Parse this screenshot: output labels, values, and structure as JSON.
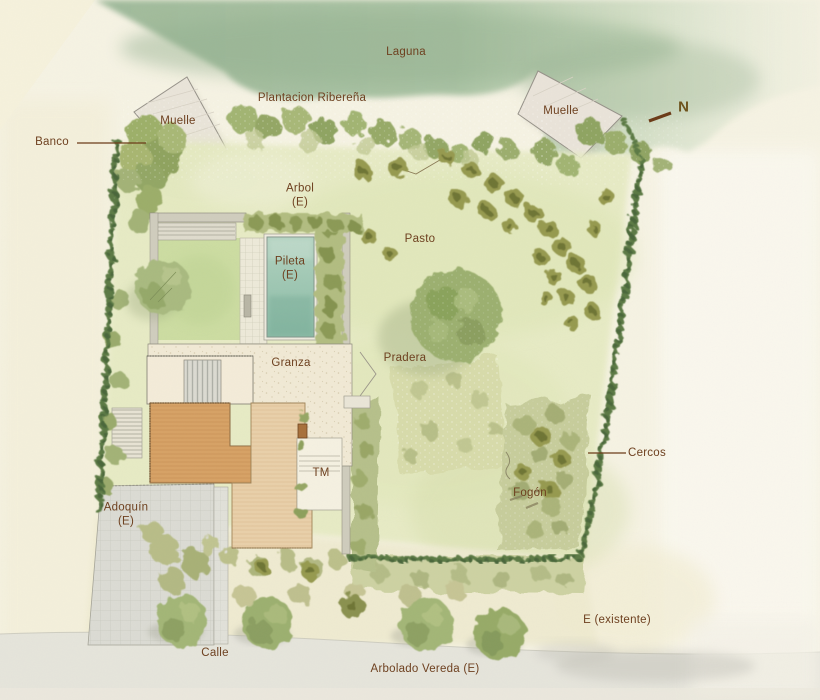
{
  "annotations": {
    "laguna": "Laguna",
    "plantacion_riberena": "Plantacion Ribereña",
    "muelle_oeste": "Muelle",
    "muelle_este": "Muelle",
    "norte": "N",
    "banco": "Banco",
    "arbol": "Arbol",
    "arbol_e": "(E)",
    "pasto": "Pasto",
    "pileta": "Pileta",
    "pileta_e": "(E)",
    "granza": "Granza",
    "pradera": "Pradera",
    "tm": "TM",
    "fogon": "Fogón",
    "cercos": "Cercos",
    "adoquin": "Adoquín",
    "adoquin_e": "(E)",
    "calle": "Calle",
    "arbolado_vereda": "Arbolado Vereda (E)",
    "existente": "E (existente)"
  },
  "palette": {
    "paper": "#f6f3e4",
    "label": "#6e4120",
    "water": "#9fbb9c",
    "pool": "#9cc5b1",
    "hedge": "#5c7a44",
    "roof": "#d7a266",
    "lawn": "#e7ebc4",
    "paving": "#dcdcd4",
    "leader": "#6b3a17"
  }
}
